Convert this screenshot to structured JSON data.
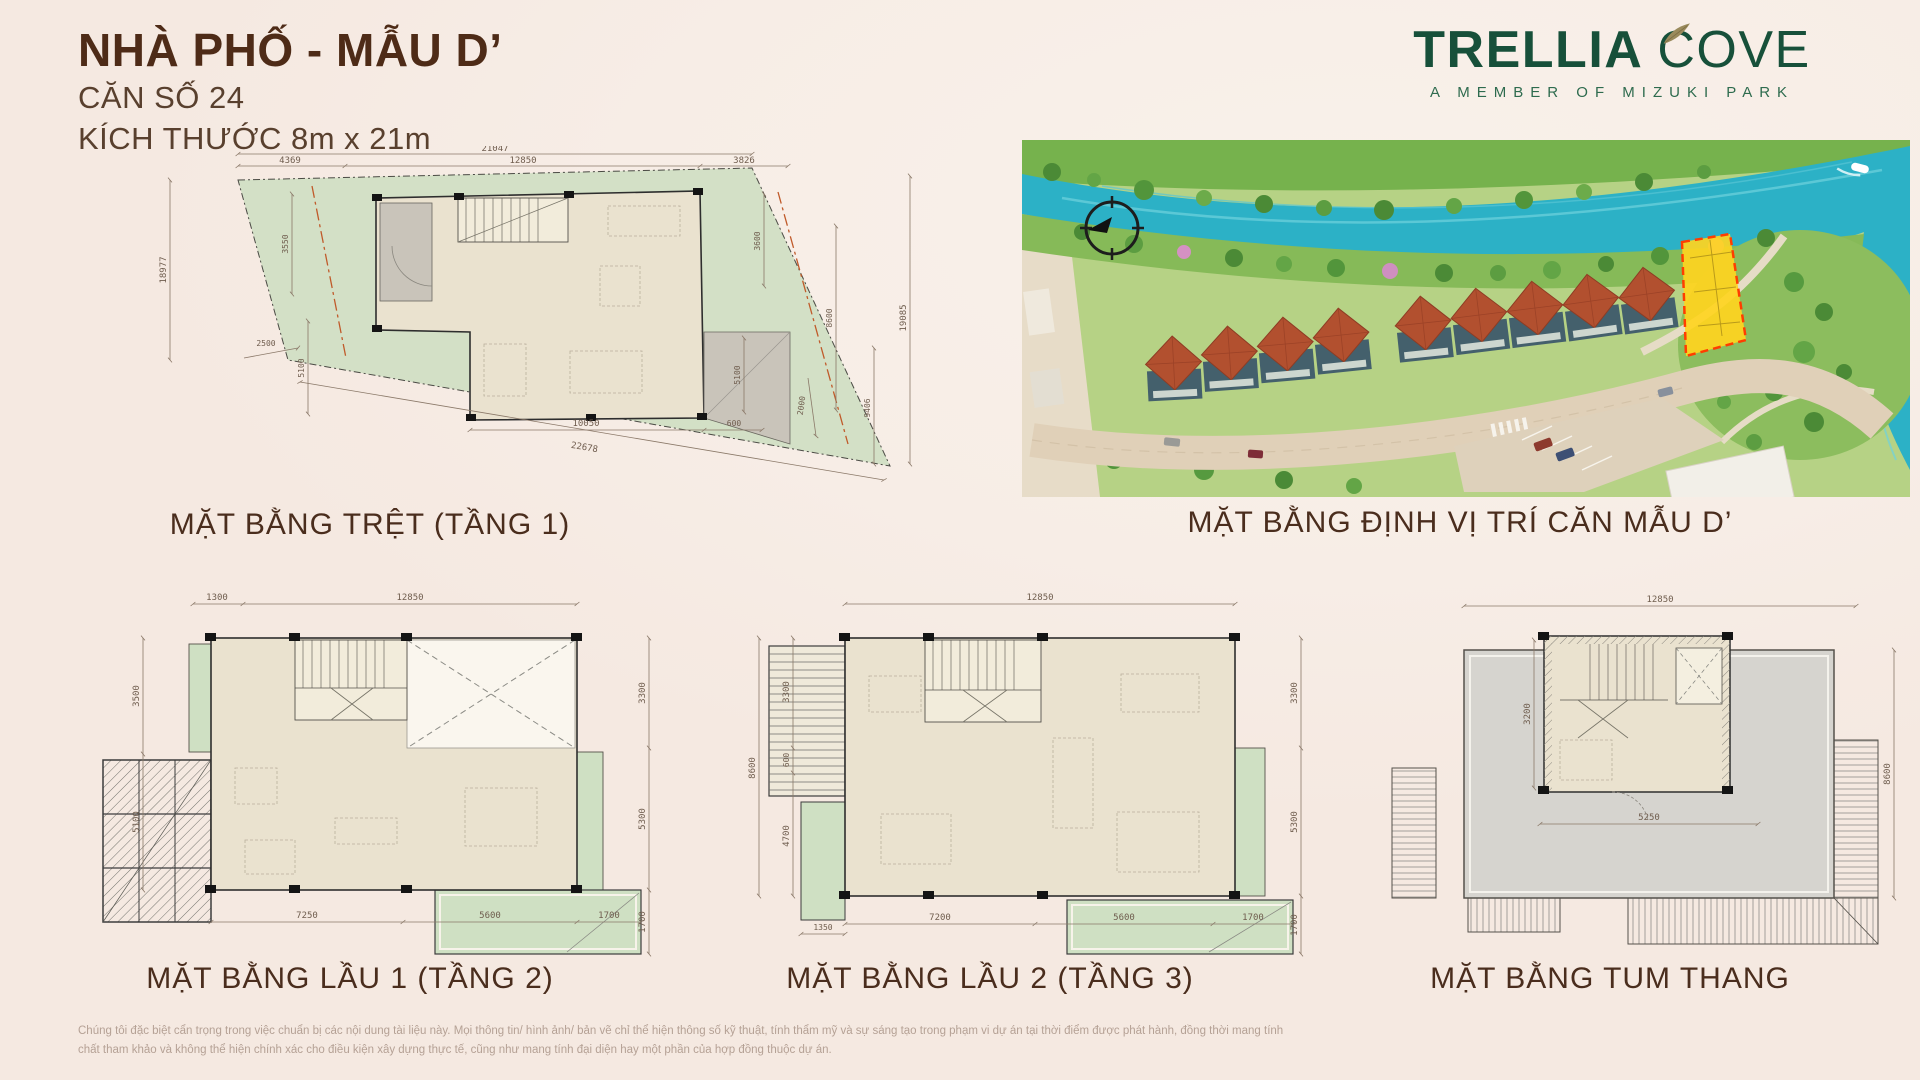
{
  "header": {
    "title": "NHÀ PHỐ - MẪU D’",
    "unit_line": "CĂN SỐ 24",
    "size_line": "KÍCH THƯỚC 8m x 21m"
  },
  "logo": {
    "brand_bold": "TRELLIA",
    "brand_light": "COVE",
    "tagline": "A MEMBER OF MIZUKI PARK",
    "brand_color": "#17503a"
  },
  "sections": {
    "ground": {
      "label": "MẶT BẰNG TRỆT (TẦNG 1)",
      "dims": {
        "total_top": "21047",
        "top": [
          "4369",
          "12850",
          "3826"
        ],
        "left_outer": "18977",
        "left": [
          "3550",
          "2500",
          "5100"
        ],
        "right": [
          "3600",
          "8600",
          "5100",
          "2000"
        ],
        "right_outer": [
          "19085",
          "9406"
        ],
        "bottom_diag": "22678",
        "bottom": [
          "10050",
          "600"
        ]
      }
    },
    "location": {
      "label": "MẶT BẰNG ĐỊNH VỊ TRÍ CĂN MẪU D’"
    },
    "floor1": {
      "label": "MẶT BẰNG LẦU 1 (TẦNG 2)",
      "dims": {
        "top": [
          "1300",
          "12850"
        ],
        "left": [
          "3500",
          "5100"
        ],
        "right": [
          "3300",
          "5300",
          "1700"
        ],
        "bottom": [
          "7250",
          "5600",
          "1700"
        ]
      }
    },
    "floor2": {
      "label": "MẶT BẰNG LẦU 2 (TẦNG 3)",
      "dims": {
        "top": [
          "12850"
        ],
        "left_outer": "8600",
        "left": [
          "3300",
          "600",
          "4700"
        ],
        "left_bottom": "1350",
        "right": [
          "3300",
          "5300",
          "1700"
        ],
        "bottom": [
          "7200",
          "5600",
          "1700"
        ]
      }
    },
    "roof": {
      "label": "MẶT BẰNG TUM THANG",
      "dims": {
        "top": [
          "12850"
        ],
        "left": [
          "3200"
        ],
        "right": [
          "8600"
        ],
        "center": [
          "5250"
        ]
      }
    }
  },
  "colors": {
    "title_brown": "#4e2b17",
    "label_brown": "#4a2d1d",
    "logo_green": "#17503a",
    "yard_green": "#d3e0c6",
    "floor_beige": "#eae2cf",
    "river_turquoise": "#2cb1c6",
    "roof_terracotta": "#b2502f",
    "highlight_yellow": "#ffd41f",
    "highlight_red": "#ff3d00"
  },
  "disclaimer": {
    "line1": "Chúng tôi đặc biệt cẩn trọng trong việc chuẩn bị các nội dung tài liệu này. Mọi thông tin/ hình ảnh/ bản vẽ chỉ thể hiện thông số kỹ thuật, tính thẩm mỹ và sự sáng tạo trong phạm vi dự án tại thời điểm được phát hành, đồng thời mang tính",
    "line2": "chất tham khảo và không thể hiện chính xác cho điều kiện xây dựng thực tế, cũng như mang tính đại diện hay một phần của hợp đồng thuộc dự án."
  }
}
